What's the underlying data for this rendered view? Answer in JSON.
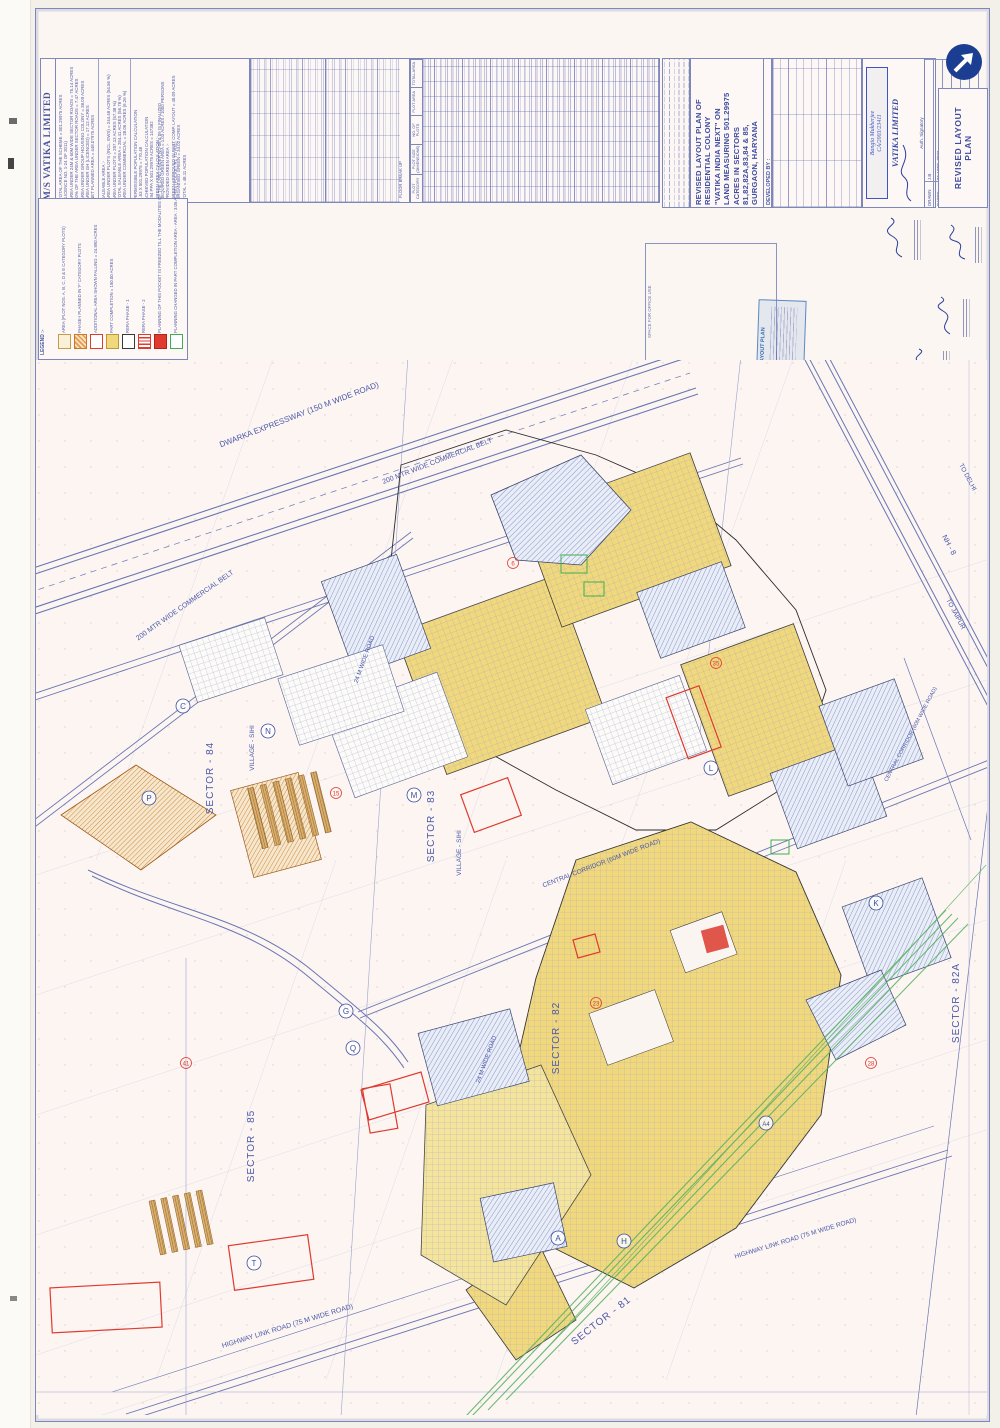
{
  "company": {
    "name": "M/S VATIKA LIMITED",
    "area_statement_p1": "TOTAL AREA OF THE SCHEME  = 501.29975 ACRES\n(LICENCE NO. 1-24 OF 2011)\nAREA UNDER 24M & 60M WIDE SECTOR ROADS  = 75.14 ACRES\n50% OF THE AREA UNDER SECTOR ROADS  = 7.47 ACRES\nAREA UNDER GROUP HOUSING COLONY  = 38.09 ACRES\nAREA UNDER GH (LICENCED)  = 17.12 ACRES\nNET PLANNED AREA  = 448.07975 ACRES",
    "area_statement_p2": "SALEABLE AREA :-\nAREA UNDER PLOTS (INCL. EWS)  = 244.48 ACRES (54.56 %)\nAREA UNDER PLOTS  = 257.13 ACRES (57.38 %)\nTOTAL SALEABLE AREA  = 254.41 ACRES (56.78 %)\nAREA UNDER COMMERCIAL  = 28.06 ACRES (6.26 %)",
    "area_statement_p3": "PERMISSIBLE POPULATION CALCULATION\n1.53 X 501.29975  = 770.48\nACHIEVED POPULATION CALCULATION\n294 PPA X 501.29975 ACRES  = 147382\nGREEN AREA CALCULATION :-\nREQUIRED GREEN AREA  = 1.03 ACRES / 1000 PERSONS\nPROVIDED GREEN AREA :-\nGREEN APPROVED IN PART COMP. LAYOUT  = 45.09 ACRES\nORGANISED GREEN  = 34.02 ACRES\nTOTAL  = 48.11 ACRES"
  },
  "legend": {
    "title": "LEGEND :-",
    "items": [
      {
        "label": "AREA (PLOT NOS. A, B, C, D & E CATEGORY PLOTS)"
      },
      {
        "label": "PHASE-I PLANNED IN 'F' CATEGORY PLOTS"
      },
      {
        "label": "ADDITIONAL AREA SHOWN FALLING = 24.890 ACRES"
      },
      {
        "label": "PART COMPLETION = 150.00 ACRES"
      },
      {
        "label": "RERA PHASE - 1"
      },
      {
        "label": "RERA PHASE - 2"
      },
      {
        "label": "PLANNING OF THIS POCKET IS FREEZED TILL THE MODALITIES OF THE LAND UNDER NO-08 & 09 IS FINALIZED"
      },
      {
        "label": "PLANNING CHANGED IN PART COMPLETION AREA - AREA : 3.06 ACRES (POCKET R1 TO R31)"
      }
    ]
  },
  "tables": {
    "header_plot_category": "PLOT CATEGORY",
    "header_plot_size": "PLOT SIZE (DIMENSIONS)",
    "header_no_of_plots": "NO. OF PLOTS",
    "header_plot_area": "PLOT AREA",
    "header_total_area": "TOTAL AREA",
    "floor_break_up": "FLOOR BREAK UP"
  },
  "title_block": {
    "project_title": "REVISED LAYOUT PLAN OF\nRESIDENTIAL COLONY\n\"VATIKA INDIA NEXT\" ON\nLAND MEASURING 501.29975\nACRES IN SECTORS\n81,82,82A,83,84 & 85,\nGURGAON, HARYANA",
    "developed_by": "DEVELOPED BY :",
    "developer": "M/S VATIKA LIMITED,\nUNIT NO. A-002, INXT CITY CENTRE,\n4TH FLOOR, BLOCK - A, SECTOR-83,\nVATIKA INDIA NEXT, GURUGRAM 122012",
    "firm": "VATIKA LIMITED",
    "auth_signatory": "Auth. Signatory",
    "architect_stamp_name": "Bangia Mukherjee",
    "architect_stamp_no": "CA/2003/23411",
    "architect_sign_label": "ARCHITECT'S SIGN.",
    "drawn_label": "DRAWN",
    "drawn": "J.B",
    "date_label": "DATED",
    "date": "05 APRIL 2023",
    "checked_label": "CHECKED",
    "checked": "G.M",
    "scale_label": "SCALE",
    "scale": "1 : 3000",
    "drg_label": "DRG. NO.",
    "drg_no": "VIN/LAY/R01/403",
    "sheet_title": "REVISED LAYOUT\nPLAN",
    "office_use": "SPACE FOR OFFICE USE",
    "office_stamp": "REVISED LAYOUT PLAN"
  },
  "map": {
    "labels": {
      "expressway": "DWARKA EXPRESSWAY  (150 M WIDE ROAD)",
      "commercial_belt": "200 MTR WIDE COMMERCIAL BELT",
      "central_corridor": "CENTRAL CORRIDOR (60M WIDE ROAD)",
      "nh8": "NH - 8",
      "to_jaipur": "TO JAIPUR",
      "to_delhi": "TO DELHI",
      "highway_link": "HIGHWAY LINK ROAD  (75 M WIDE ROAD)",
      "village": "VILLAGE - SIHI",
      "road24": "24 M WIDE ROAD"
    },
    "sectors": [
      "SECTOR - 84",
      "SECTOR - 83",
      "SECTOR - 85",
      "SECTOR - 82",
      "SECTOR - 82A",
      "SECTOR - 81"
    ],
    "pocket_markers": [
      "C",
      "N",
      "P",
      "M",
      "G",
      "Q",
      "A",
      "H",
      "T",
      "A4",
      "K",
      "L"
    ],
    "ref_markers": [
      "6",
      "15",
      "23",
      "35",
      "41",
      "28"
    ]
  },
  "colors": {
    "blueprint": "#5a66a8",
    "yellow": "#f1d87c",
    "orange": "#e0933c",
    "red": "#e0392e",
    "green": "#44a85a",
    "brown": "#9a6428",
    "logo_blue": "#1c3e92"
  }
}
